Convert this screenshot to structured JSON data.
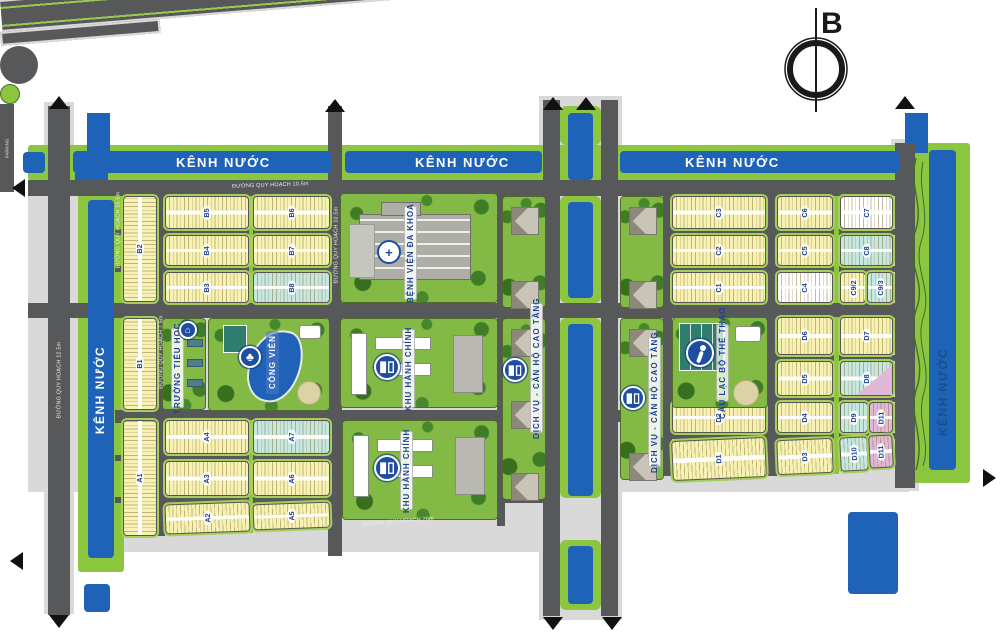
{
  "north": {
    "label": "B"
  },
  "canal_label": "KÊNH NƯỚC",
  "parking_label": "PARKING",
  "road_labels": [
    {
      "text": "ĐƯỜNG QUY HOẠCH 10.5m",
      "x": 232,
      "y": 183,
      "rot": -2,
      "anchor": "tl"
    },
    {
      "text": "ĐƯỜNG QUY HOẠCH 10.5m",
      "x": 336,
      "y": 245,
      "rot": -90,
      "anchor": "c"
    },
    {
      "text": "ĐƯỜNG QUY HOẠCH 10.5m",
      "x": 118,
      "y": 230,
      "rot": -90,
      "anchor": "c"
    },
    {
      "text": "ĐƯỜNG QUY HOẠCH 12.5m",
      "x": 59,
      "y": 380,
      "rot": -90,
      "anchor": "c"
    },
    {
      "text": "ĐƯỜNG QUY HOẠCH 7.5m",
      "x": 161,
      "y": 352,
      "rot": -90,
      "anchor": "c"
    },
    {
      "text": "ĐƯỜNG QUY HOẠCH 26m",
      "x": 362,
      "y": 521,
      "rot": -4.7,
      "anchor": "tl"
    }
  ],
  "canal_labels": [
    {
      "x": 176,
      "y": 155,
      "vertical": false,
      "color": "#ffffff"
    },
    {
      "x": 415,
      "y": 155,
      "vertical": false,
      "color": "#ffffff"
    },
    {
      "x": 685,
      "y": 155,
      "vertical": false,
      "color": "#ffffff"
    },
    {
      "x": 100,
      "y": 390,
      "vertical": true,
      "color": "#ffffff"
    },
    {
      "x": 943,
      "y": 392,
      "vertical": true,
      "color": "#174f8e"
    }
  ],
  "colors": {
    "road": "#57585a",
    "casing": "#d9d9d9",
    "canal_blue": "#1e63b8",
    "canal_green": "#8cc63f",
    "block_trim": "#a6ce5a",
    "label_blue": "#1c3f94",
    "lot_yellow": "#f7f2b4",
    "lot_cyan": "#c6e8e1",
    "lot_white": "#ffffff",
    "lot_pink": "#e2b8d8"
  },
  "base_rects": [
    [
      44,
      102,
      30,
      512
    ],
    [
      28,
      176,
      881,
      316
    ],
    [
      115,
      484,
      447,
      68
    ],
    [
      539,
      96,
      83,
      524
    ],
    [
      891,
      139,
      28,
      352
    ]
  ],
  "canal_green": [
    [
      28,
      145,
      880,
      35
    ],
    [
      78,
      192,
      46,
      380
    ],
    [
      908,
      143,
      62,
      340
    ]
  ],
  "median_green": [
    [
      560,
      106,
      41,
      39
    ],
    [
      560,
      196,
      41,
      107
    ],
    [
      560,
      318,
      41,
      180
    ],
    [
      560,
      540,
      41,
      70
    ]
  ],
  "pre_blue": [
    [
      87,
      113,
      23,
      40
    ],
    [
      75,
      173,
      33,
      20
    ],
    [
      905,
      113,
      23,
      40
    ]
  ],
  "canal_blue": [
    [
      23,
      152,
      22,
      21
    ],
    [
      73,
      151,
      258,
      22
    ],
    [
      345,
      151,
      197,
      22
    ],
    [
      620,
      151,
      280,
      22
    ],
    [
      88,
      200,
      26,
      358
    ],
    [
      929,
      150,
      27,
      320
    ],
    [
      568,
      113,
      25,
      67
    ],
    [
      568,
      202,
      25,
      96
    ],
    [
      568,
      324,
      25,
      172
    ],
    [
      568,
      546,
      25,
      58
    ],
    [
      84,
      584,
      26,
      28
    ],
    [
      848,
      512,
      50,
      82
    ]
  ],
  "roads": [
    [
      28,
      180,
      877,
      16
    ],
    [
      115,
      229,
      430,
      6
    ],
    [
      663,
      229,
      242,
      6
    ],
    [
      115,
      266,
      430,
      6
    ],
    [
      663,
      266,
      242,
      6
    ],
    [
      28,
      303,
      877,
      15
    ],
    [
      663,
      355,
      242,
      6
    ],
    [
      663,
      397,
      242,
      5
    ],
    [
      663,
      433,
      242,
      6
    ],
    [
      115,
      410,
      445,
      13
    ],
    [
      618,
      410,
      45,
      12
    ],
    [
      115,
      455,
      430,
      6
    ],
    [
      115,
      497,
      430,
      6
    ],
    [
      48,
      106,
      22,
      505
    ],
    [
      48,
      575,
      22,
      40
    ],
    [
      157,
      196,
      8,
      340
    ],
    [
      328,
      106,
      14,
      450
    ],
    [
      497,
      196,
      8,
      330
    ],
    [
      543,
      100,
      17,
      516
    ],
    [
      601,
      100,
      17,
      516
    ],
    [
      663,
      196,
      9,
      280
    ],
    [
      766,
      196,
      11,
      280
    ],
    [
      895,
      143,
      20,
      345
    ]
  ],
  "dividers": [
    [
      249,
      196,
      4,
      107
    ],
    [
      249,
      420,
      4,
      113
    ],
    [
      834,
      196,
      5,
      107
    ],
    [
      834,
      317,
      5,
      157
    ]
  ],
  "bottom_road": {
    "x": 22,
    "y": 549,
    "w": 975,
    "h": 32,
    "rot": -4.7
  },
  "bottom_stub": {
    "x": 20,
    "y": 588,
    "w": 160,
    "h": 14,
    "rot": -4.7
  },
  "roundabout": {
    "x": 584,
    "y": 517,
    "d_outer": 38,
    "d_inner": 20
  },
  "blocks": [
    {
      "l": "B2",
      "x": 123,
      "y": 196,
      "w": 34,
      "h": 106,
      "f": "y",
      "o": "v"
    },
    {
      "l": "B5",
      "x": 165,
      "y": 196,
      "w": 84,
      "h": 33,
      "f": "y",
      "o": "h"
    },
    {
      "l": "B6",
      "x": 253,
      "y": 196,
      "w": 77,
      "h": 33,
      "f": "y",
      "o": "h"
    },
    {
      "l": "B4",
      "x": 165,
      "y": 235,
      "w": 84,
      "h": 31,
      "f": "y",
      "o": "h"
    },
    {
      "l": "B7",
      "x": 253,
      "y": 235,
      "w": 77,
      "h": 31,
      "f": "y",
      "o": "h"
    },
    {
      "l": "B3",
      "x": 165,
      "y": 272,
      "w": 84,
      "h": 31,
      "f": "y",
      "o": "h"
    },
    {
      "l": "B8",
      "x": 253,
      "y": 272,
      "w": 77,
      "h": 31,
      "f": "c",
      "o": "h"
    },
    {
      "l": "B1",
      "x": 123,
      "y": 318,
      "w": 34,
      "h": 92,
      "f": "y",
      "o": "v"
    },
    {
      "l": "A1",
      "x": 123,
      "y": 420,
      "w": 34,
      "h": 116,
      "f": "y",
      "o": "v"
    },
    {
      "l": "A4",
      "x": 165,
      "y": 420,
      "w": 84,
      "h": 34,
      "f": "y",
      "o": "h"
    },
    {
      "l": "A7",
      "x": 253,
      "y": 420,
      "w": 77,
      "h": 34,
      "f": "c",
      "o": "h"
    },
    {
      "l": "A3",
      "x": 165,
      "y": 461,
      "w": 84,
      "h": 35,
      "f": "y",
      "o": "h"
    },
    {
      "l": "A6",
      "x": 253,
      "y": 461,
      "w": 77,
      "h": 35,
      "f": "y",
      "o": "h"
    },
    {
      "l": "A2",
      "x": 165,
      "y": 503,
      "w": 85,
      "h": 30,
      "f": "y",
      "o": "h",
      "r": -2
    },
    {
      "l": "A5",
      "x": 253,
      "y": 503,
      "w": 77,
      "h": 26,
      "f": "y",
      "o": "h",
      "r": -2
    },
    {
      "l": "C3",
      "x": 672,
      "y": 196,
      "w": 94,
      "h": 33,
      "f": "y",
      "o": "h"
    },
    {
      "l": "C6",
      "x": 777,
      "y": 196,
      "w": 56,
      "h": 33,
      "f": "y",
      "o": "h"
    },
    {
      "l": "C7",
      "x": 840,
      "y": 196,
      "w": 53,
      "h": 33,
      "f": "w",
      "o": "h"
    },
    {
      "l": "C2",
      "x": 672,
      "y": 235,
      "w": 94,
      "h": 31,
      "f": "y",
      "o": "h"
    },
    {
      "l": "C5",
      "x": 777,
      "y": 235,
      "w": 56,
      "h": 31,
      "f": "y",
      "o": "h"
    },
    {
      "l": "C8",
      "x": 840,
      "y": 235,
      "w": 53,
      "h": 31,
      "f": "c",
      "o": "h"
    },
    {
      "l": "C1",
      "x": 672,
      "y": 272,
      "w": 94,
      "h": 31,
      "f": "y",
      "o": "h"
    },
    {
      "l": "C4",
      "x": 777,
      "y": 272,
      "w": 56,
      "h": 31,
      "f": "w",
      "o": "h"
    },
    {
      "l": "C9/2",
      "x": 840,
      "y": 272,
      "w": 26,
      "h": 31,
      "f": "y",
      "o": "h"
    },
    {
      "l": "C9/3",
      "x": 867,
      "y": 272,
      "w": 26,
      "h": 31,
      "f": "c",
      "o": "h"
    },
    {
      "l": "D6",
      "x": 777,
      "y": 317,
      "w": 56,
      "h": 38,
      "f": "y",
      "o": "h"
    },
    {
      "l": "D7",
      "x": 840,
      "y": 317,
      "w": 53,
      "h": 38,
      "f": "y",
      "o": "h"
    },
    {
      "l": "D5",
      "x": 777,
      "y": 361,
      "w": 56,
      "h": 35,
      "f": "y",
      "o": "h"
    },
    {
      "l": "D8",
      "x": 840,
      "y": 361,
      "w": 53,
      "h": 35,
      "f": "c",
      "o": "h",
      "pink": true
    },
    {
      "l": "D2",
      "x": 672,
      "y": 402,
      "w": 94,
      "h": 31,
      "f": "y",
      "o": "h"
    },
    {
      "l": "D4",
      "x": 777,
      "y": 402,
      "w": 56,
      "h": 31,
      "f": "y",
      "o": "h"
    },
    {
      "l": "D9",
      "x": 840,
      "y": 402,
      "w": 28,
      "h": 31,
      "f": "c",
      "o": "h"
    },
    {
      "l": "D11",
      "x": 869,
      "y": 402,
      "w": 24,
      "h": 31,
      "f": "p",
      "o": "h"
    },
    {
      "l": "D1",
      "x": 672,
      "y": 439,
      "w": 94,
      "h": 40,
      "f": "y",
      "o": "h",
      "r": -2.5
    },
    {
      "l": "D3",
      "x": 777,
      "y": 439,
      "w": 56,
      "h": 35,
      "f": "y",
      "o": "h",
      "r": -2.5
    },
    {
      "l": "D10",
      "x": 840,
      "y": 437,
      "w": 28,
      "h": 34,
      "f": "c",
      "o": "h",
      "r": -3
    },
    {
      "l": "D11",
      "x": 869,
      "y": 435,
      "w": 24,
      "h": 33,
      "f": "p",
      "o": "h",
      "r": -3
    }
  ],
  "facilities": [
    {
      "id": "hospital",
      "label": "BỆNH VIỆN ĐA KHOA",
      "x": 340,
      "y": 193,
      "w": 158,
      "h": 110,
      "lab": {
        "x": 404,
        "y": 206,
        "h": 94
      },
      "icon": {
        "k": "cross",
        "g": "+",
        "x": 389,
        "y": 252,
        "d": 24
      },
      "deco": "hospital"
    },
    {
      "id": "school",
      "label": "TRƯỜNG TIỂU HỌC",
      "x": 162,
      "y": 318,
      "w": 44,
      "h": 92,
      "lab": {
        "x": 171,
        "y": 328,
        "h": 80
      },
      "icon": {
        "k": "bldg",
        "g": "⌂",
        "x": 188,
        "y": 330,
        "d": 18
      },
      "deco": "school"
    },
    {
      "id": "park",
      "label": "CÔNG VIÊN",
      "x": 208,
      "y": 318,
      "w": 122,
      "h": 93,
      "lab": {
        "x": 266,
        "y": 331,
        "h": 63,
        "style": "park"
      },
      "icon": {
        "k": "tree",
        "g": "♣",
        "x": 250,
        "y": 357,
        "d": 22
      },
      "deco": "park"
    },
    {
      "id": "admin-1",
      "label": "KHU HÀNH CHÍNH",
      "x": 340,
      "y": 318,
      "w": 158,
      "h": 90,
      "lab": {
        "x": 402,
        "y": 329,
        "h": 79
      },
      "icon": {
        "k": "bldg",
        "g": "▮▯",
        "x": 387,
        "y": 367,
        "d": 26
      },
      "deco": "admin"
    },
    {
      "id": "admin-2",
      "label": "KHU HÀNH CHÍNH",
      "x": 342,
      "y": 420,
      "w": 156,
      "h": 100,
      "lab": {
        "x": 400,
        "y": 431,
        "h": 79
      },
      "icon": {
        "k": "bldg",
        "g": "▮▯",
        "x": 387,
        "y": 468,
        "d": 26
      },
      "deco": "admin"
    },
    {
      "id": "sports-club",
      "label": "CÂU LẠC BỘ THỂ THAO",
      "x": 672,
      "y": 317,
      "w": 96,
      "h": 91,
      "lab": {
        "x": 716,
        "y": 324,
        "h": 78,
        "style": "club"
      },
      "icon": {
        "k": "person",
        "x": 700,
        "y": 353,
        "d": 28
      },
      "deco": "sports"
    },
    {
      "id": "villas-nw",
      "label": "",
      "x": 502,
      "y": 196,
      "w": 44,
      "h": 112,
      "deco": "villas"
    },
    {
      "id": "villas-ne",
      "label": "",
      "x": 620,
      "y": 196,
      "w": 44,
      "h": 112,
      "deco": "villas"
    },
    {
      "id": "villas-sw",
      "label": "DỊCH VỤ - CĂN HỘ CAO TẦNG",
      "x": 502,
      "y": 318,
      "w": 44,
      "h": 182,
      "lab": {
        "x": 530,
        "y": 303,
        "h": 130
      },
      "icon": {
        "k": "bldg",
        "g": "▮▯",
        "x": 515,
        "y": 370,
        "d": 24
      },
      "deco": "villas"
    },
    {
      "id": "villas-se",
      "label": "DỊCH VỤ - CĂN HỘ CAO TẦNG",
      "x": 620,
      "y": 318,
      "w": 44,
      "h": 162,
      "lab": {
        "x": 648,
        "y": 337,
        "h": 130
      },
      "icon": {
        "k": "bldg",
        "g": "▮▯",
        "x": 633,
        "y": 398,
        "d": 24
      },
      "deco": "villas"
    }
  ],
  "arrows": [
    {
      "dir": "up",
      "x": 59,
      "y": 96
    },
    {
      "dir": "up",
      "x": 335,
      "y": 99
    },
    {
      "dir": "up",
      "x": 553,
      "y": 97
    },
    {
      "dir": "up",
      "x": 586,
      "y": 97
    },
    {
      "dir": "up",
      "x": 905,
      "y": 96
    },
    {
      "dir": "left",
      "x": 12,
      "y": 188
    },
    {
      "dir": "left",
      "x": 10,
      "y": 561
    },
    {
      "dir": "down",
      "x": 59,
      "y": 615
    },
    {
      "dir": "down",
      "x": 553,
      "y": 617
    },
    {
      "dir": "down",
      "x": 612,
      "y": 617
    },
    {
      "dir": "right",
      "x": 983,
      "y": 478
    }
  ]
}
